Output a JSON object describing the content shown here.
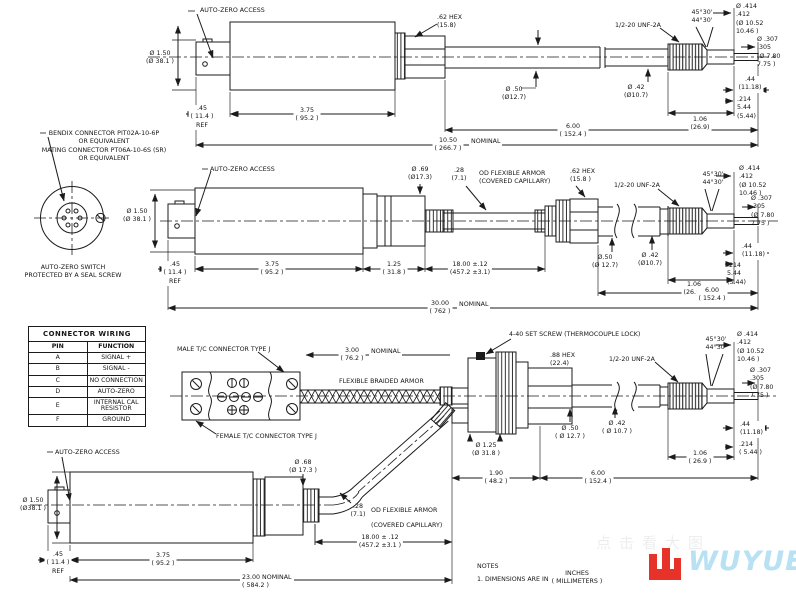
{
  "connector_view": {
    "callout": "BENDIX CONNECTOR PIT02A-10-6P\nOR EQUIVALENT\nMATING CONNECTOR PT06A-10-6S (SR)\nOR EQUIVALENT",
    "caption": "AUTO-ZERO SWITCH\nPROTECTED BY A SEAL SCREW"
  },
  "table": {
    "title": "CONNECTOR WIRING",
    "col_pin": "PIN",
    "col_function": "FUNCTION",
    "rows": [
      {
        "pin": "A",
        "fn": "SIGNAL +"
      },
      {
        "pin": "B",
        "fn": "SIGNAL -"
      },
      {
        "pin": "C",
        "fn": "NO CONNECTION"
      },
      {
        "pin": "D",
        "fn": "AUTO-ZERO"
      },
      {
        "pin": "E",
        "fn": "INTERNAL CAL RESISTOR"
      },
      {
        "pin": "F",
        "fn": "GROUND"
      }
    ]
  },
  "row1": {
    "auto_zero": "AUTO-ZERO ACCESS",
    "dia_150": "Ø 1.50\n(Ø 38.1 )",
    "hex_62": ".62 HEX\n(15.8)",
    "dia_50": "Ø .50\n(Ø12.7)",
    "dia_42": "Ø .42\n(Ø10.7)",
    "thread": "1/2-20 UNF-2A",
    "chamfer": "45°30'\n44°30'",
    "dia_414": "Ø .414\n.412\n(Ø 10.52\n10.46 )",
    "dia_307": "Ø .307\n.305\n(Ø 7.80\n7.75 )",
    "dim_44": ".44\n(11.18)",
    "dim_214": ".214\n5.44\n(5.44)",
    "dim_106": "1.06\n(26.9)",
    "dim_600": "6.00\n( 152.4 )",
    "dim_1050": "10.50\n( 266.7 )",
    "nominal": "NOMINAL",
    "dim_45": ".45\n( 11.4 )\nREF",
    "dim_375": "3.75\n( 95.2 )"
  },
  "row2": {
    "auto_zero": "AUTO-ZERO ACCESS",
    "dia_150": "Ø 1.50\n(Ø 38.1 )",
    "dia_69": "Ø .69\n(Ø17.3)",
    "armor_size": ".28\n(7.1)",
    "armor_label": "OD FLEXIBLE ARMOR\n(COVERED CAPILLARY)",
    "hex_62": ".62 HEX\n(15.8 )",
    "thread": "1/2-20 UNF-2A",
    "chamfer": "45°30'\n44°30'",
    "dia_414": "Ø .414\n.412\n(Ø 10.52\n10.46 )",
    "dia_307": "Ø .307\n.305\n(Ø 7.80\n7.75 )",
    "dia_50": "Ø.50\n(Ø 12.7)",
    "dia_42": "Ø .42\n(Ø10.7)",
    "dim_44": ".44\n(11.18)",
    "dim_214": ".214\n5.44\n(5.44)",
    "dim_106": "1.06\n(26.9 )",
    "dim_600": "6.00\n( 152.4 )",
    "dim_3000": "30.00\n( 762 )",
    "nominal": "NOMINAL",
    "dim_45": ".45\n( 11.4 )\nREF",
    "dim_375": "3.75\n( 95.2 )",
    "dim_125": "1.25\n( 31.8 )",
    "dim_1800": "18.00 ±.12\n(457.2 ±3.1)"
  },
  "row3": {
    "male_tc": "MALE T/C CONNECTOR TYPE J",
    "female_tc": "FEMALE T/C CONNECTOR TYPE J",
    "dim_300": "3.00\n( 76.2 )",
    "nominal": "NOMINAL",
    "braided": "FLEXIBLE BRAIDED ARMOR",
    "set_screw": "4-40 SET SCREW (THERMOCOUPLE LOCK)",
    "hex_88": ".88 HEX\n(22.4)",
    "thread": "1/2-20 UNF-2A",
    "chamfer": "45°30'\n44°30'",
    "dia_414": "Ø .414\n.412\n(Ø 10.52\n10.46 )",
    "dia_307": "Ø .307\n.305\n(Ø 7.80\n7.75 )",
    "dia_50": "Ø .50\n( Ø 12.7 )",
    "dia_42": "Ø .42\n( Ø 10.7 )",
    "dia_125": "Ø 1.25\n(Ø 31.8 )",
    "dim_44": ".44\n(11.18)",
    "dim_214": ".214\n( 5.44 )",
    "dim_106": "1.06\n( 26.9 )",
    "dim_190": "1.90\n( 48.2 )",
    "dim_600": "6.00\n( 152.4 )"
  },
  "row4": {
    "auto_zero": "AUTO-ZERO ACCESS",
    "dia_150": "Ø 1.50\n(Ø38.1 )",
    "dia_68": "Ø .68\n(Ø 17.3 )",
    "armor_size": ".28\n(7.1)",
    "armor_label": "OD FLEXIBLE ARMOR\n(COVERED CAPILLARY)",
    "dim_45": ".45\n( 11.4 )\nREF",
    "dim_375": "3.75\n( 95.2 )",
    "dim_1800": "18.00 ± .12\n(457.2 ±3.1 )",
    "dim_2300": "23.00 NOMINAL\n( 584.2 )"
  },
  "notes": {
    "title": "NOTES",
    "line1": "1. DIMENSIONS ARE IN",
    "units": "INCHES\n( MILLIMETERS )"
  },
  "logo": {
    "text": "WUYUE",
    "watermark": "点击看大图",
    "color_glyph": "#e63229",
    "color_text": "#b9e1f4"
  }
}
